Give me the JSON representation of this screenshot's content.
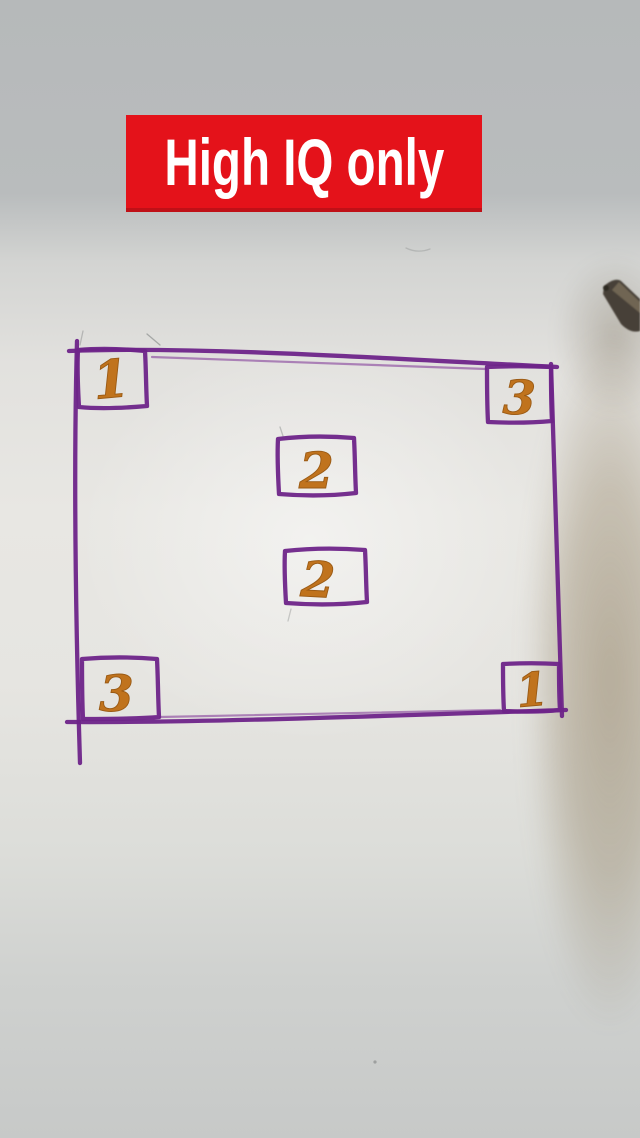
{
  "banner": {
    "label": "High IQ only",
    "bg_color": "#e4121a",
    "text_color": "#ffffff"
  },
  "puzzle": {
    "ink_color": "#6e2489",
    "number_color": "#c0731d",
    "corners": {
      "top_left": "1",
      "top_right": "3",
      "bottom_left": "3",
      "bottom_right": "1"
    },
    "centers": [
      "2",
      "2"
    ]
  },
  "scene": {
    "desk_color": "#b8bbbc",
    "paper_color": "#e8e7e3",
    "pen_icon": "marker-pen-tip"
  }
}
